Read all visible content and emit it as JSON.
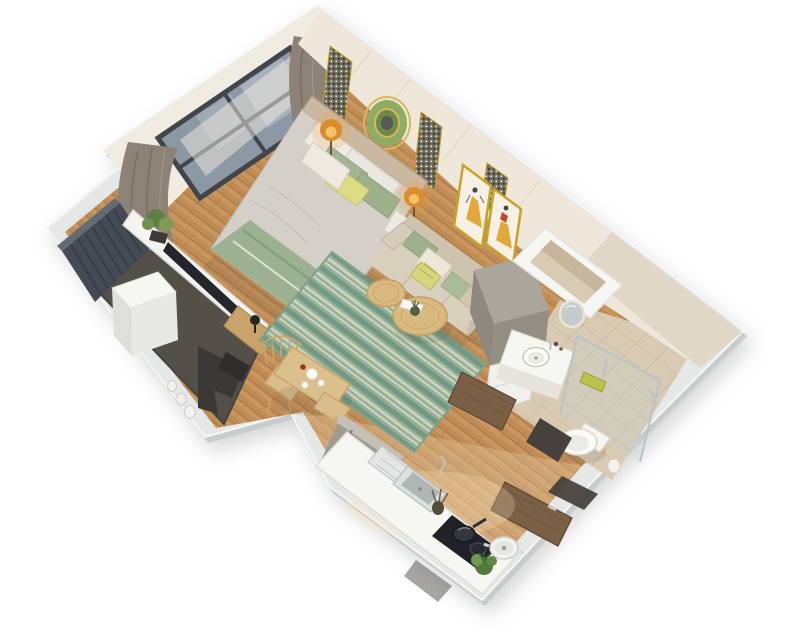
{
  "scene": {
    "title": "3D isometric cutaway floor plan render of a studio apartment",
    "style": "top-down isometric 3D render on white background"
  },
  "palette": {
    "background": "#ffffff",
    "wall_top": "#e4e8e7",
    "wall_face_cream": "#efe8da",
    "wall_face_light": "#f1ece1",
    "wood_floor": "#bf8c55",
    "wood_stripe": "#cf9f66",
    "wood_line": "#a1713f",
    "kitchen_floor_tint": "#f0ddba",
    "balcony_carpet": "#53504a",
    "slat_wall": "#454b54",
    "bathroom_tile": "#d9cbb3",
    "tile_line": "#c3b294",
    "rug_base": "#93b19b",
    "rug_stripe_dark": "#6f9a84",
    "rug_stripe_light": "#cdd5ba",
    "sofa_body": "#d8cfbd",
    "sofa_back": "#cdc3ae",
    "bed_duvet": "#d4d0c9",
    "blanket_sage": "#9cb191",
    "pillow_green": "#a3b492",
    "pillow_yellow": "#dcdc85",
    "headboard_wood": "#cbb8a0",
    "curtain_taupe": "#8d8276",
    "sheer": "#f1ece2",
    "window_glass": "#8c99a4",
    "window_frame": "#41464c",
    "table_wood": "#dcc08c",
    "coffee_table_wood": "#d9b97e",
    "door_walnut": "#7a5f45",
    "gold_accent": "#c9a227",
    "art_yellow": "#e2a93a",
    "art_red": "#c44a33",
    "mirror_green": "#8fac64",
    "lamp_glow": "#f2a43e",
    "appliance_gray": "#a09b91",
    "cabinet_gray": "#938f84",
    "fixture_white": "#f6f6f2",
    "hob_black": "#1f2226",
    "plant_green": "#5f7f44"
  },
  "rooms": [
    {
      "name": "Bedroom",
      "floor": "wood"
    },
    {
      "name": "Living area",
      "floor": "wood with green striped rug"
    },
    {
      "name": "Balcony",
      "floor": "dark carpet"
    },
    {
      "name": "Dining nook",
      "floor": "wood"
    },
    {
      "name": "Kitchen",
      "floor": "wood"
    },
    {
      "name": "Bathroom",
      "floor": "beige tile"
    },
    {
      "name": "Technical shaft",
      "floor": "enclosed duct"
    }
  ],
  "furniture": {
    "bedroom": [
      "double bed with gray duvet",
      "sage striped runner",
      "white green and yellow pillows",
      "upholstered headboard",
      "two nightstands",
      "two lit amber table lamps",
      "green circular wall mirror with gold ring",
      "patterned wall panel strips",
      "large dark-framed window",
      "taupe curtains",
      "sheer curtain"
    ],
    "living": [
      "beige sofa with scatter cushions",
      "two framed yellow-dress artworks",
      "green striped area rug",
      "two round wooden coffee tables",
      "tray and table plant",
      "tall gray cabinet",
      "white drawer unit"
    ],
    "balcony": [
      "dark slatted privacy screen",
      "white washing machine",
      "dark lounge chair",
      "floor bottles",
      "low white parapet console",
      "flat TV on console",
      "potted plant",
      "wooden side cabinet with black lamp"
    ],
    "dining": [
      "light oak dining table",
      "two spindle-back chairs",
      "white tea set",
      "red jar"
    ],
    "kitchen": [
      "white countertop run",
      "stainless sink with drainboard",
      "utensil crock",
      "induction hob with pan",
      "white stock pot",
      "herb plant",
      "gray refrigerator"
    ],
    "bathroom": [
      "white vanity with round basin",
      "round wall mirror",
      "glass shower enclosure",
      "lime shower caddy",
      "toilet",
      "small waste bin"
    ],
    "entry": [
      "open walnut entry door",
      "open walnut bathroom door",
      "dark thresholds"
    ]
  }
}
